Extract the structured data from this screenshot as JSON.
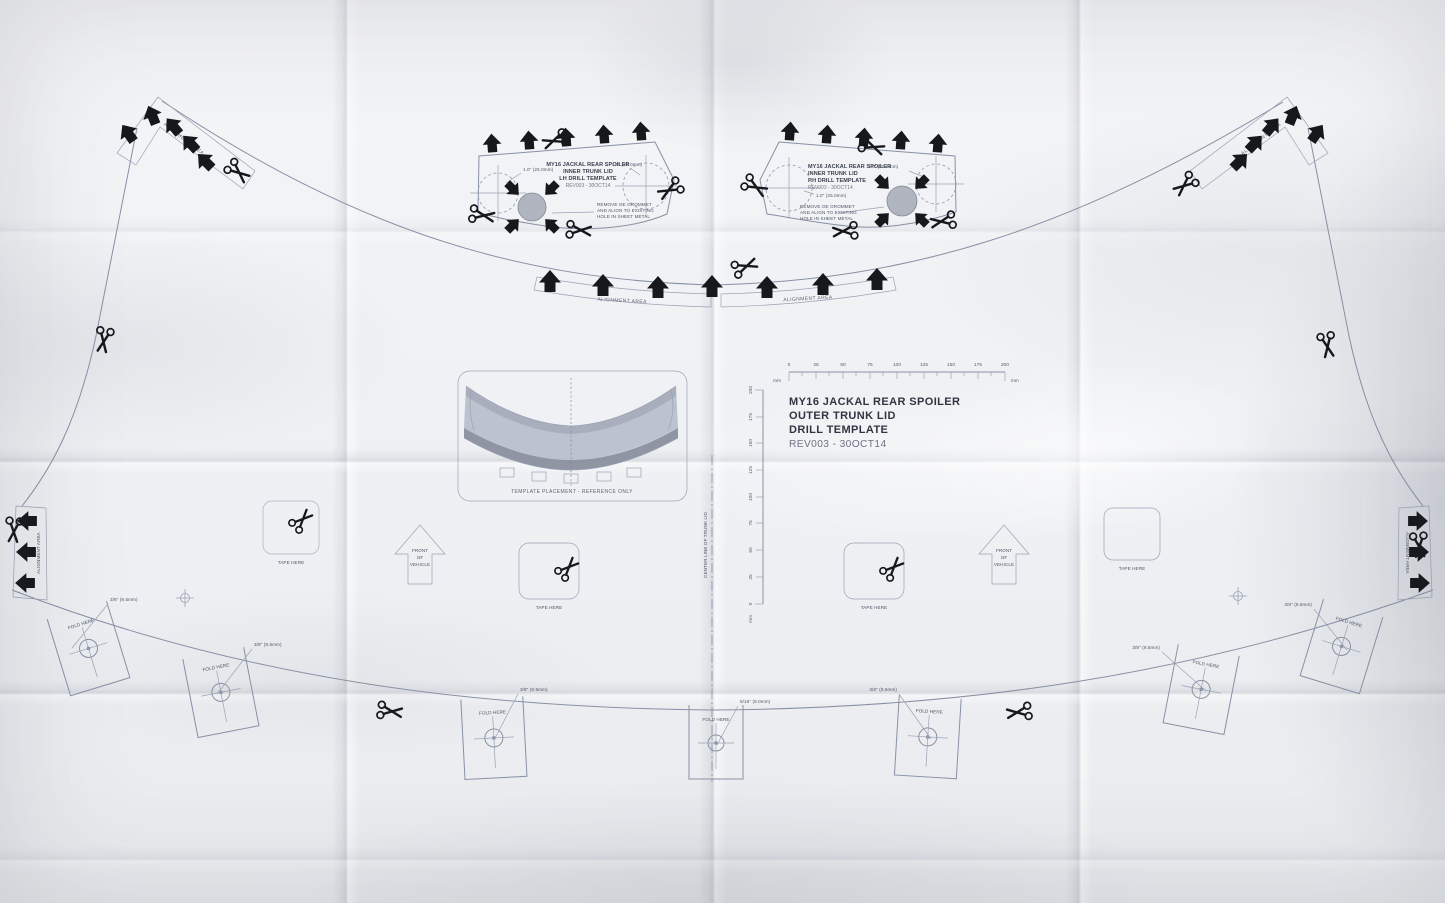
{
  "titles": {
    "outer": {
      "l1": "MY16 JACKAL REAR SPOILER",
      "l2": "OUTER TRUNK LID",
      "l3": "DRILL TEMPLATE",
      "l4": "REV003 - 30OCT14"
    },
    "inner_lh": {
      "l1": "MY16 JACKAL REAR SPOILER",
      "l2": "INNER TRUNK LID",
      "l3": "LH DRILL TEMPLATE",
      "l4": "REV003 - 30OCT14"
    },
    "inner_rh": {
      "l1": "MY16 JACKAL REAR SPOILER",
      "l2": "INNER TRUNK LID",
      "l3": "RH DRILL TEMPLATE",
      "l4": "REV003 - 30OCT14"
    }
  },
  "notes": {
    "grommet_l1": "REMOVE OE GROMMET",
    "grommet_l2": "AND ALIGN TO EXISTING",
    "grommet_l3": "HOLE IN SHEET METAL"
  },
  "labels": {
    "alignment_area": "ALIGNMENT AREA",
    "tape_here": "TAPE HERE",
    "fold_here": "FOLD HERE",
    "front_l1": "FRONT",
    "front_l2": "OF",
    "front_l3": "VEHICLE",
    "center_line": "CENTER LINE OF TRUNK LID",
    "placement_caption": "TEMPLATE PLACEMENT - REFERENCE ONLY",
    "drill_38": "3/8\" (9.5mm)",
    "drill_516": "5/16\" (8.0mm)",
    "dim_1in": "1.0\" (25.0mm)",
    "unit": "mm"
  },
  "ruler": {
    "ticks": [
      "0",
      "25",
      "50",
      "75",
      "100",
      "125",
      "150",
      "175",
      "200"
    ]
  },
  "colors": {
    "print": "#8791a6",
    "ink": "#16181c",
    "title": "#2f3642",
    "paper": "#f2f3f5"
  }
}
